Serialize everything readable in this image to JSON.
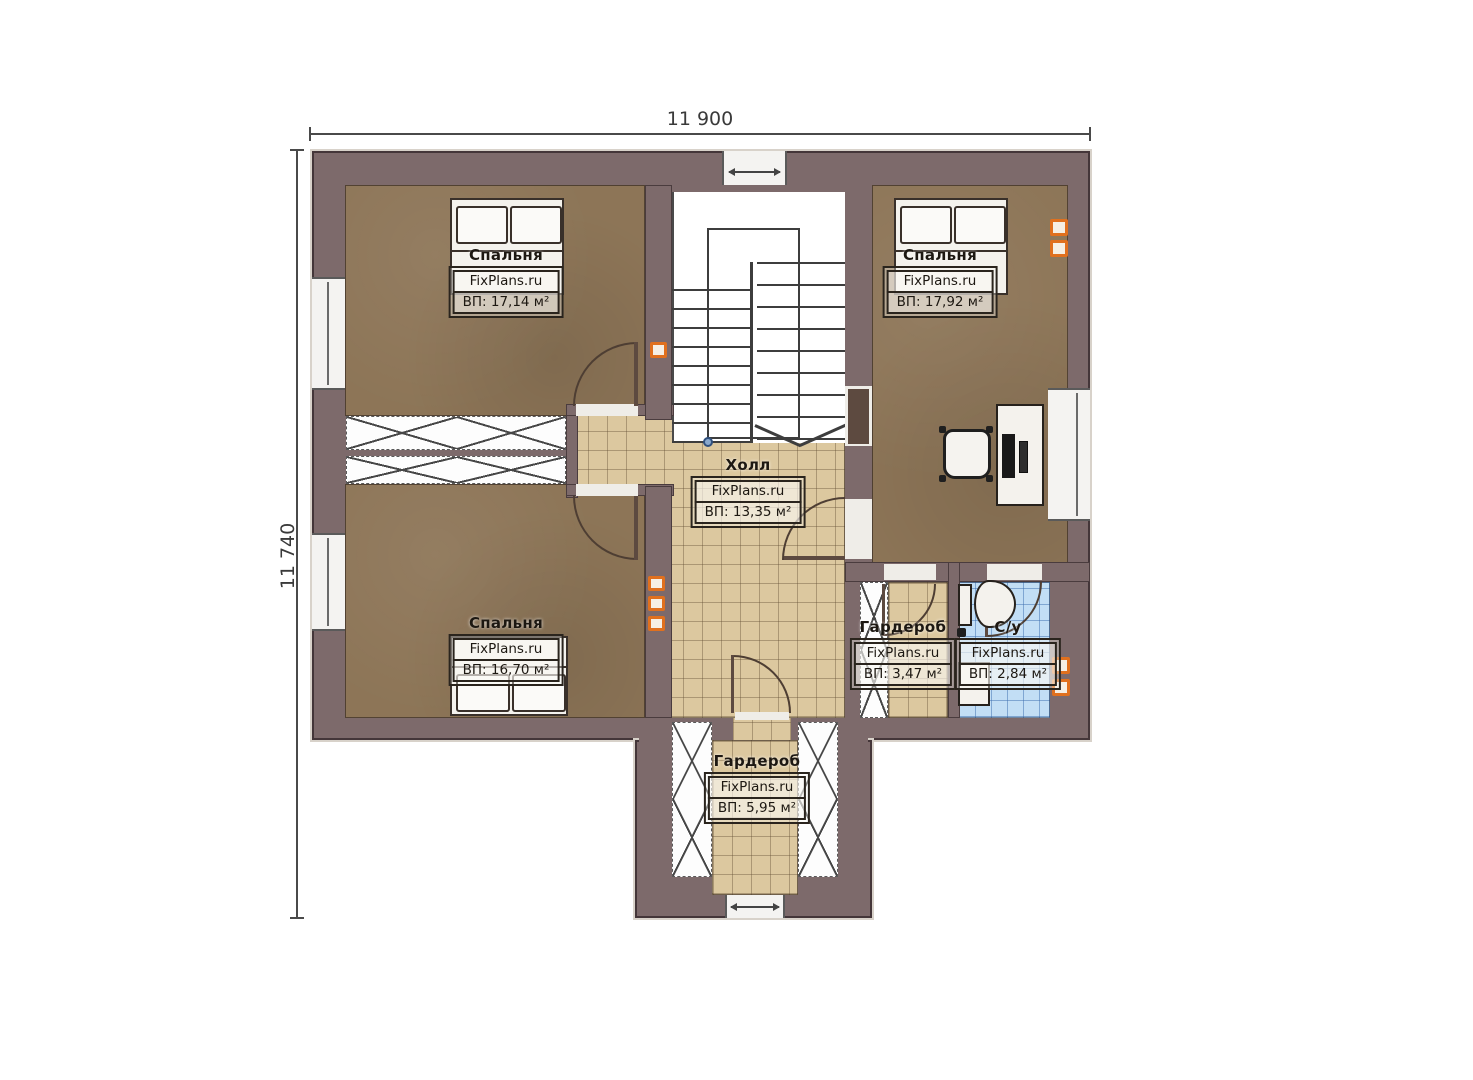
{
  "watermark": "FixPlans.ru",
  "dimensions": {
    "width": "11 900",
    "height": "11 740"
  },
  "rooms": [
    {
      "key": "bedroom-top-left",
      "name": "Спальня",
      "area": "ВП: 17,14 м²"
    },
    {
      "key": "bedroom-top-right",
      "name": "Спальня",
      "area": "ВП: 17,92 м²"
    },
    {
      "key": "hall",
      "name": "Холл",
      "area": "ВП: 13,35 м²"
    },
    {
      "key": "bedroom-bottom-left",
      "name": "Спальня",
      "area": "ВП: 16,70 м²"
    },
    {
      "key": "wardrobe-right",
      "name": "Гардероб",
      "area": "ВП: 3,47 м²"
    },
    {
      "key": "bathroom",
      "name": "С/у",
      "area": "ВП: 2,84 м²"
    },
    {
      "key": "wardrobe-bottom",
      "name": "Гардероб",
      "area": "ВП: 5,95 м²"
    }
  ],
  "colors": {
    "wall": "#7d6a6b",
    "carpet": "#8d7557",
    "tile": "#dcc89f",
    "bathroom_tile": "#c2def5",
    "accent_orange": "#e0701e"
  }
}
